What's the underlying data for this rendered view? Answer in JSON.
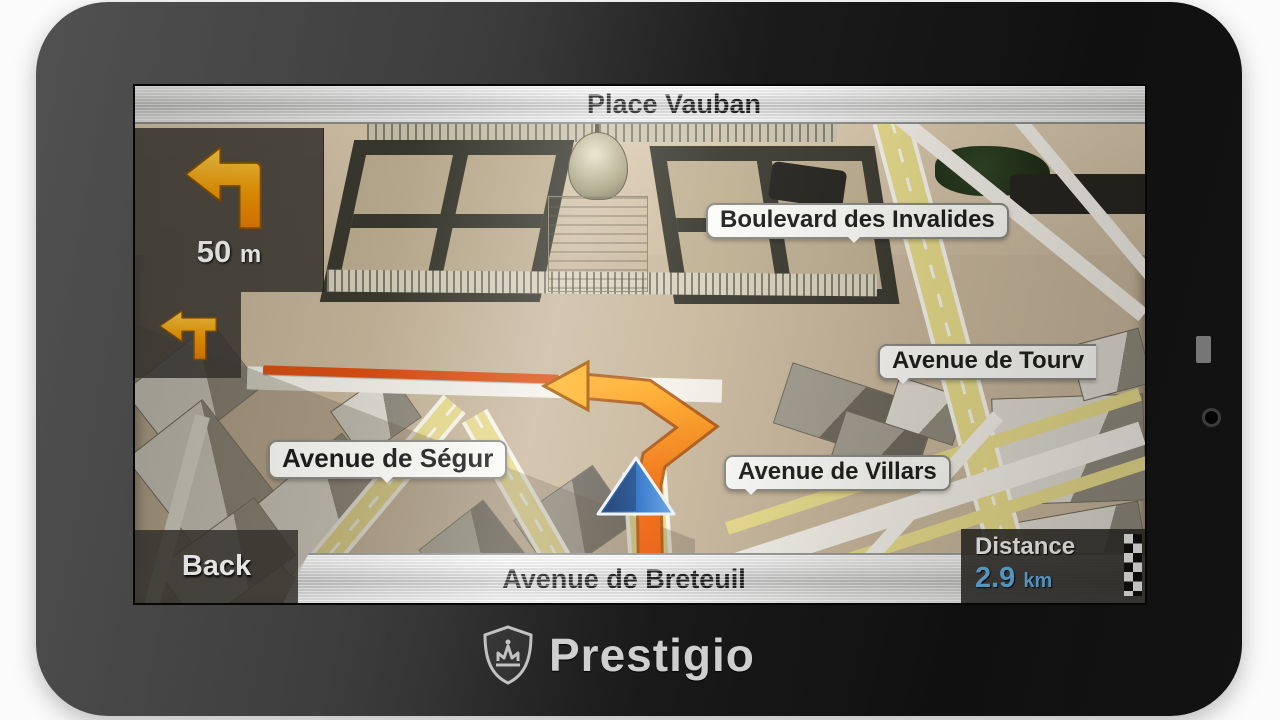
{
  "brand": {
    "name": "Prestigio",
    "logo_icon": "crown-shield-icon"
  },
  "navigation": {
    "top_bar": {
      "next_street": "Place Vauban"
    },
    "maneuver_panel": {
      "icon": "turn-left-arrow-icon",
      "distance_value": "50",
      "distance_unit": "m"
    },
    "secondary_maneuver_panel": {
      "icon": "then-turn-left-icon"
    },
    "bottom_bar": {
      "back_label": "Back",
      "current_street": "Avenue de Breteuil"
    },
    "distance_panel": {
      "label": "Distance",
      "value": "2.9",
      "unit": "km",
      "icon": "checkered-flag-icon"
    },
    "map": {
      "street_labels": [
        "Boulevard des Invalides",
        "Avenue de Tourv",
        "Avenue de Ségur",
        "Avenue de Villars"
      ],
      "position_marker": "current-position-arrow"
    }
  },
  "colors": {
    "route_orange": "#f08a14",
    "route_red": "#dd4f12",
    "distance_cyan": "#5fb0e6",
    "map_ground": "#c9b89d",
    "road_yellow": "#e9dd8c",
    "hud_panel": "rgba(56,54,48,0.86)"
  }
}
